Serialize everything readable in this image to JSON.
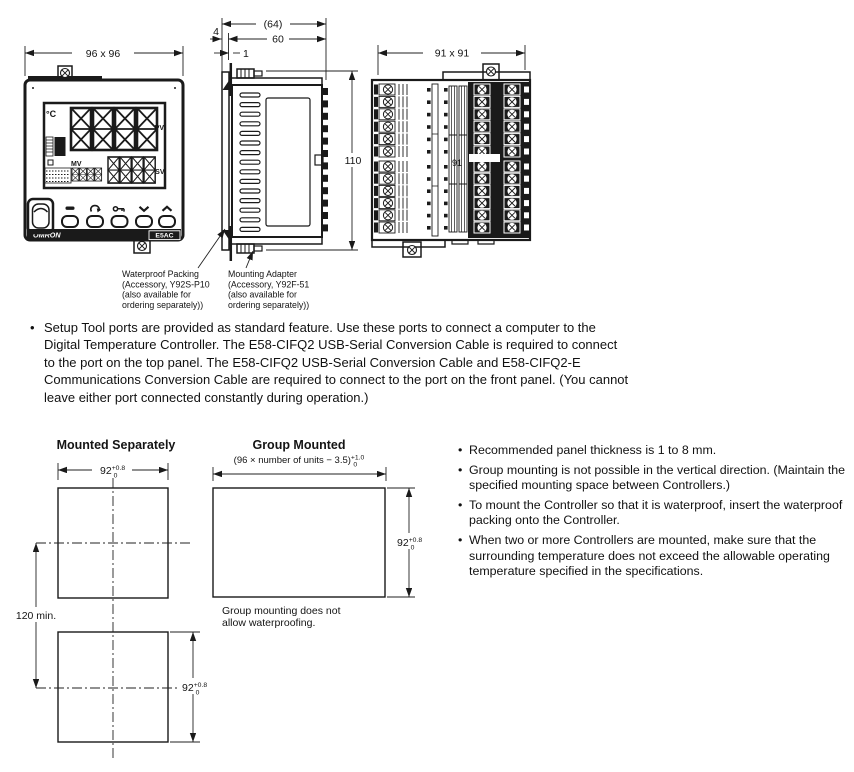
{
  "front_view": {
    "dim": "96 x 96",
    "display": {
      "unit": "°C",
      "pv_label": "PV",
      "sv_label": "SV",
      "mv_label": "MV"
    },
    "brand": "OMRON",
    "model": "E5AC"
  },
  "side_view": {
    "dim_overall": "(64)",
    "dim_depth": "60",
    "dim_bezel": "4",
    "dim_panel": "1",
    "dim_height": "110"
  },
  "rear_view": {
    "dim": "91 x 91",
    "faint_mark": "91"
  },
  "callouts": {
    "packing": [
      "Waterproof Packing",
      "(Accessory, Y92S-P10",
      "(also available for",
      "ordering separately))"
    ],
    "adapter": [
      "Mounting Adapter",
      "(Accessory, Y92F-51",
      "(also available for",
      "ordering separately))"
    ]
  },
  "setup_note": "Setup Tool ports are provided as standard feature. Use these ports to connect a computer to the Digital Temperature Controller. The E58-CIFQ2 USB-Serial Conversion Cable is required to connect to the port on the top panel. The E58-CIFQ2 USB-Serial Conversion Cable and E58-CIFQ2-E Communications Conversion Cable are required to connect to the port on the front panel. (You cannot leave either port connected constantly during operation.)",
  "cutouts": {
    "separate_title": "Mounted Separately",
    "group_title": "Group Mounted",
    "group_formula": "(96 × number of units − 3.5)",
    "dim_92": "92",
    "tol_high_08": "+0.8",
    "tol_high_10": "+1.0",
    "tol_low": "0",
    "dim_vertical": "120 min.",
    "group_caption": [
      "Group mounting does not",
      "allow waterproofing."
    ]
  },
  "notes": [
    "Recommended panel thickness is 1 to 8 mm.",
    "Group mounting is not possible in the vertical direction. (Maintain the specified mounting space between Controllers.)",
    "To mount the Controller so that it is waterproof, insert the waterproof packing onto the Controller.",
    "When two or more Controllers are mounted, make sure that the surrounding temperature does not exceed the allowable operating temperature specified in the specifications."
  ]
}
